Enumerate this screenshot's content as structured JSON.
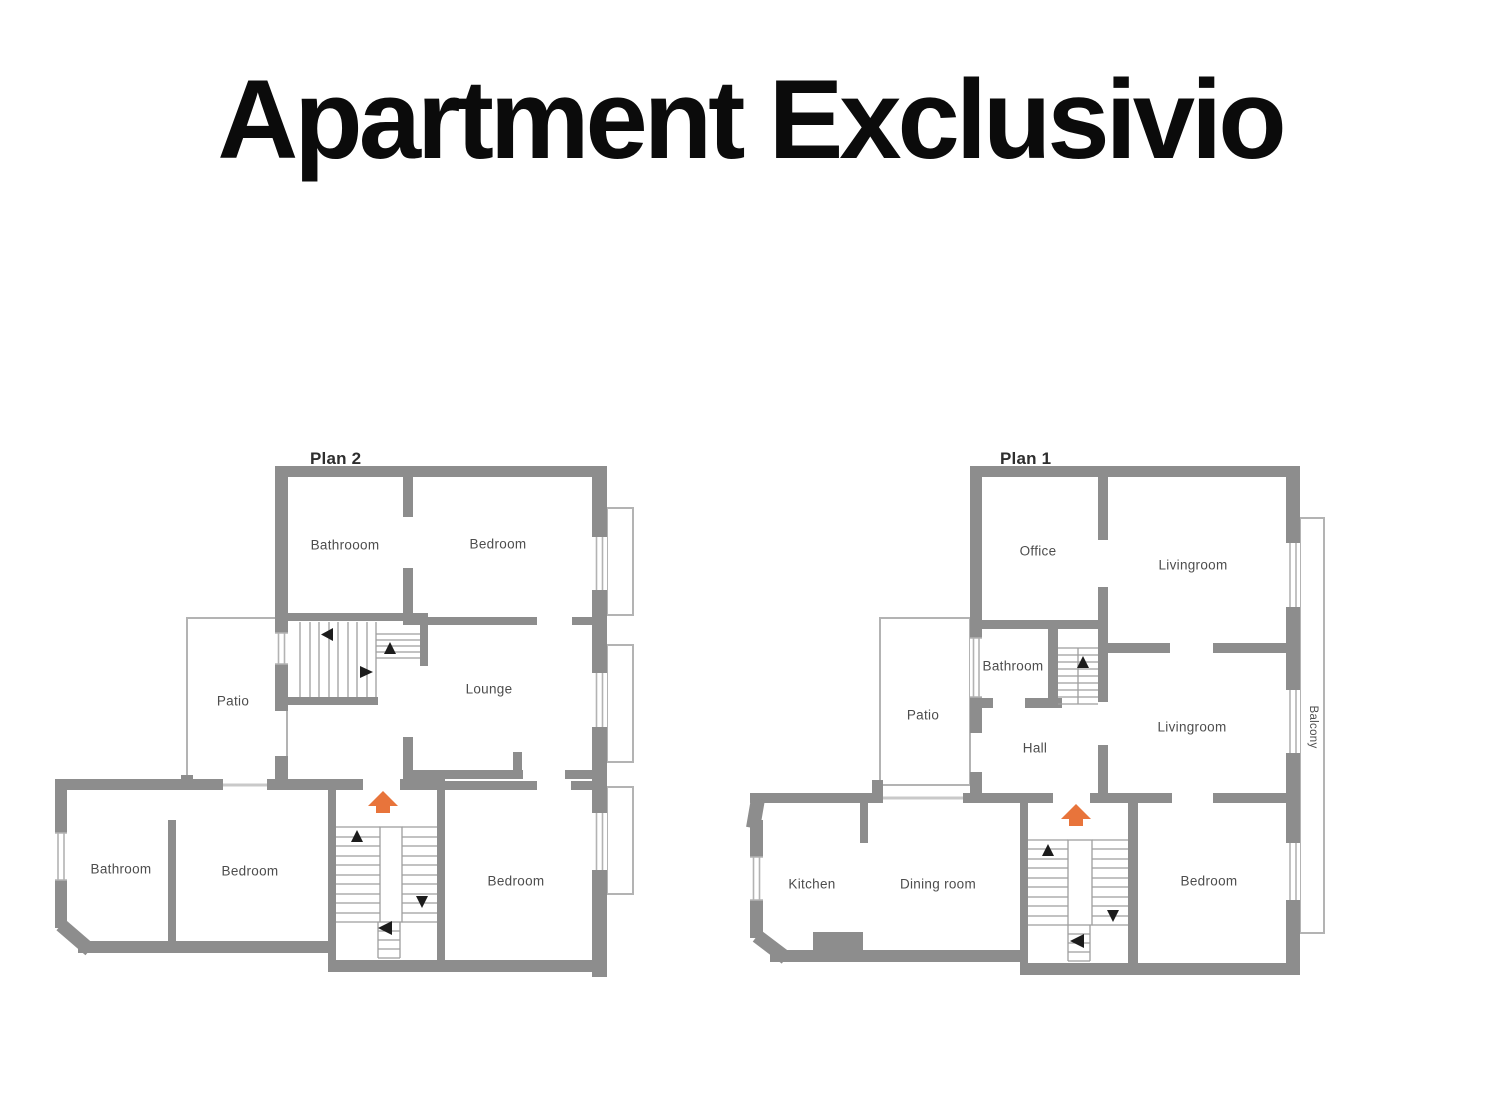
{
  "title": "Apartment Exclusivio",
  "plan2": {
    "title": "Plan 2",
    "rooms": {
      "bathroom_top": "Bathrooom",
      "bedroom_top": "Bedroom",
      "patio": "Patio",
      "lounge": "Lounge",
      "bathroom_bottom": "Bathroom",
      "bedroom_bottom": "Bedroom",
      "bedroom_right": "Bedroom"
    }
  },
  "plan1": {
    "title": "Plan 1",
    "rooms": {
      "office": "Office",
      "livingroom_top": "Livingroom",
      "bathroom": "Bathroom",
      "patio": "Patio",
      "hall": "Hall",
      "livingroom_mid": "Livingroom",
      "balcony": "Balcony",
      "kitchen": "Kitchen",
      "dining": "Dining room",
      "bedroom": "Bedroom"
    }
  },
  "colors": {
    "wall_gray": "#8d8d8d",
    "thin_outline_gray": "#b3b3b3",
    "stair_line_gray": "#9e9e9e",
    "light_door_gray": "#c9c9c9",
    "arrow_black": "#1c1c1c",
    "accent_orange": "#e8743b",
    "label_text": "#4d4d4d",
    "title_text": "#0b0b0b"
  },
  "icons": {
    "entrance-arrow-icon": "orange up-arrow marking stair entrance",
    "stair-direction-arrow-icon": "black triangle marking stair direction"
  }
}
